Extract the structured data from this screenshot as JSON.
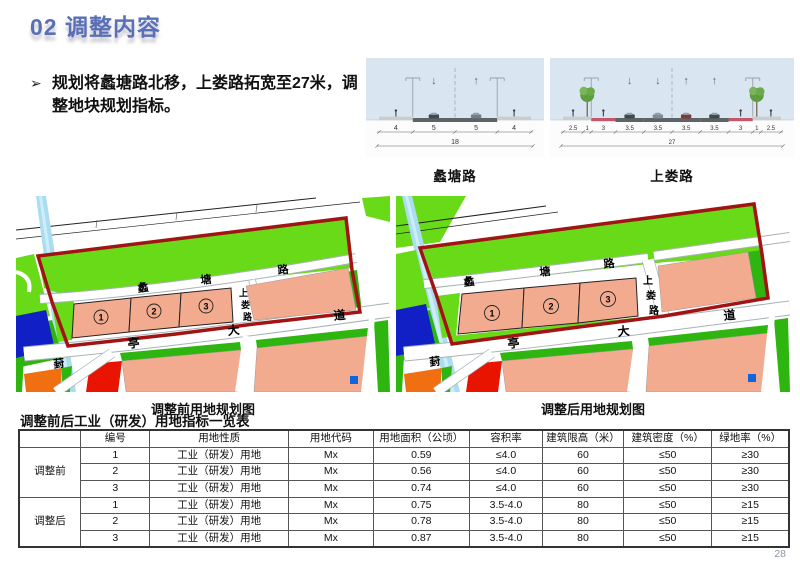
{
  "page": {
    "title": "02 调整内容",
    "page_number": "28"
  },
  "intro": {
    "marker": "➢",
    "text": "规划将蠡塘路北移，上娄路拓宽至27米，调整地块规划指标。"
  },
  "cross_sections": [
    {
      "caption": "蠡塘路",
      "segment_widths": [
        "4",
        "5",
        "5",
        "4"
      ],
      "total_width": "18",
      "lane_arrows": [
        "↓",
        "↑"
      ]
    },
    {
      "caption": "上娄路",
      "segment_widths": [
        "2.5",
        "1",
        "3",
        "3.5",
        "3.5",
        "3.5",
        "3.5",
        "3",
        "1",
        "2.5"
      ],
      "total_width": "27",
      "lane_arrows": [
        "↓",
        "↓",
        "↑",
        "↑"
      ]
    }
  ],
  "maps": {
    "before": {
      "caption": "调整前用地规划图",
      "roads": {
        "litang": [
          "蠡",
          "塘",
          "路"
        ],
        "shanglou": [
          "上",
          "娄",
          "路"
        ],
        "tingda": [
          "亭",
          "大",
          "道"
        ],
        "feng": "葑"
      },
      "plots": [
        "1",
        "2",
        "3"
      ]
    },
    "after": {
      "caption": "调整后用地规划图",
      "roads": {
        "litang": [
          "蠡",
          "塘",
          "路"
        ],
        "shanglou": [
          "上",
          "娄",
          "路"
        ],
        "tingda": [
          "亭",
          "大",
          "道"
        ],
        "feng": "葑"
      },
      "plots": [
        "1",
        "2",
        "3"
      ]
    }
  },
  "table": {
    "title": "调整前后工业（研发）用地指标一览表",
    "headers": [
      "编号",
      "用地性质",
      "用地代码",
      "用地面积（公顷）",
      "容积率",
      "建筑限高（米）",
      "建筑密度（%）",
      "绿地率（%）"
    ],
    "groups": [
      {
        "label": "调整前",
        "rows": [
          [
            "1",
            "工业（研发）用地",
            "Mx",
            "0.59",
            "≤4.0",
            "60",
            "≤50",
            "≥30"
          ],
          [
            "2",
            "工业（研发）用地",
            "Mx",
            "0.56",
            "≤4.0",
            "60",
            "≤50",
            "≥30"
          ],
          [
            "3",
            "工业（研发）用地",
            "Mx",
            "0.74",
            "≤4.0",
            "60",
            "≤50",
            "≥30"
          ]
        ]
      },
      {
        "label": "调整后",
        "rows": [
          [
            "1",
            "工业（研发）用地",
            "Mx",
            "0.75",
            "3.5-4.0",
            "80",
            "≤50",
            "≥15"
          ],
          [
            "2",
            "工业（研发）用地",
            "Mx",
            "0.78",
            "3.5-4.0",
            "80",
            "≤50",
            "≥15"
          ],
          [
            "3",
            "工业（研发）用地",
            "Mx",
            "0.87",
            "3.5-4.0",
            "80",
            "≤50",
            "≥15"
          ]
        ]
      }
    ]
  },
  "colors": {
    "title_blue": "#5A6FB8",
    "plot_salmon": "#F2AB8E",
    "green_bright": "#69DA18",
    "green_deep": "#2FB50F",
    "boundary_red": "#A21414",
    "parcel_red": "#E81400",
    "parcel_orange": "#F07011",
    "parcel_blue": "#1120C4",
    "water_blue": "#A9DDEF"
  }
}
